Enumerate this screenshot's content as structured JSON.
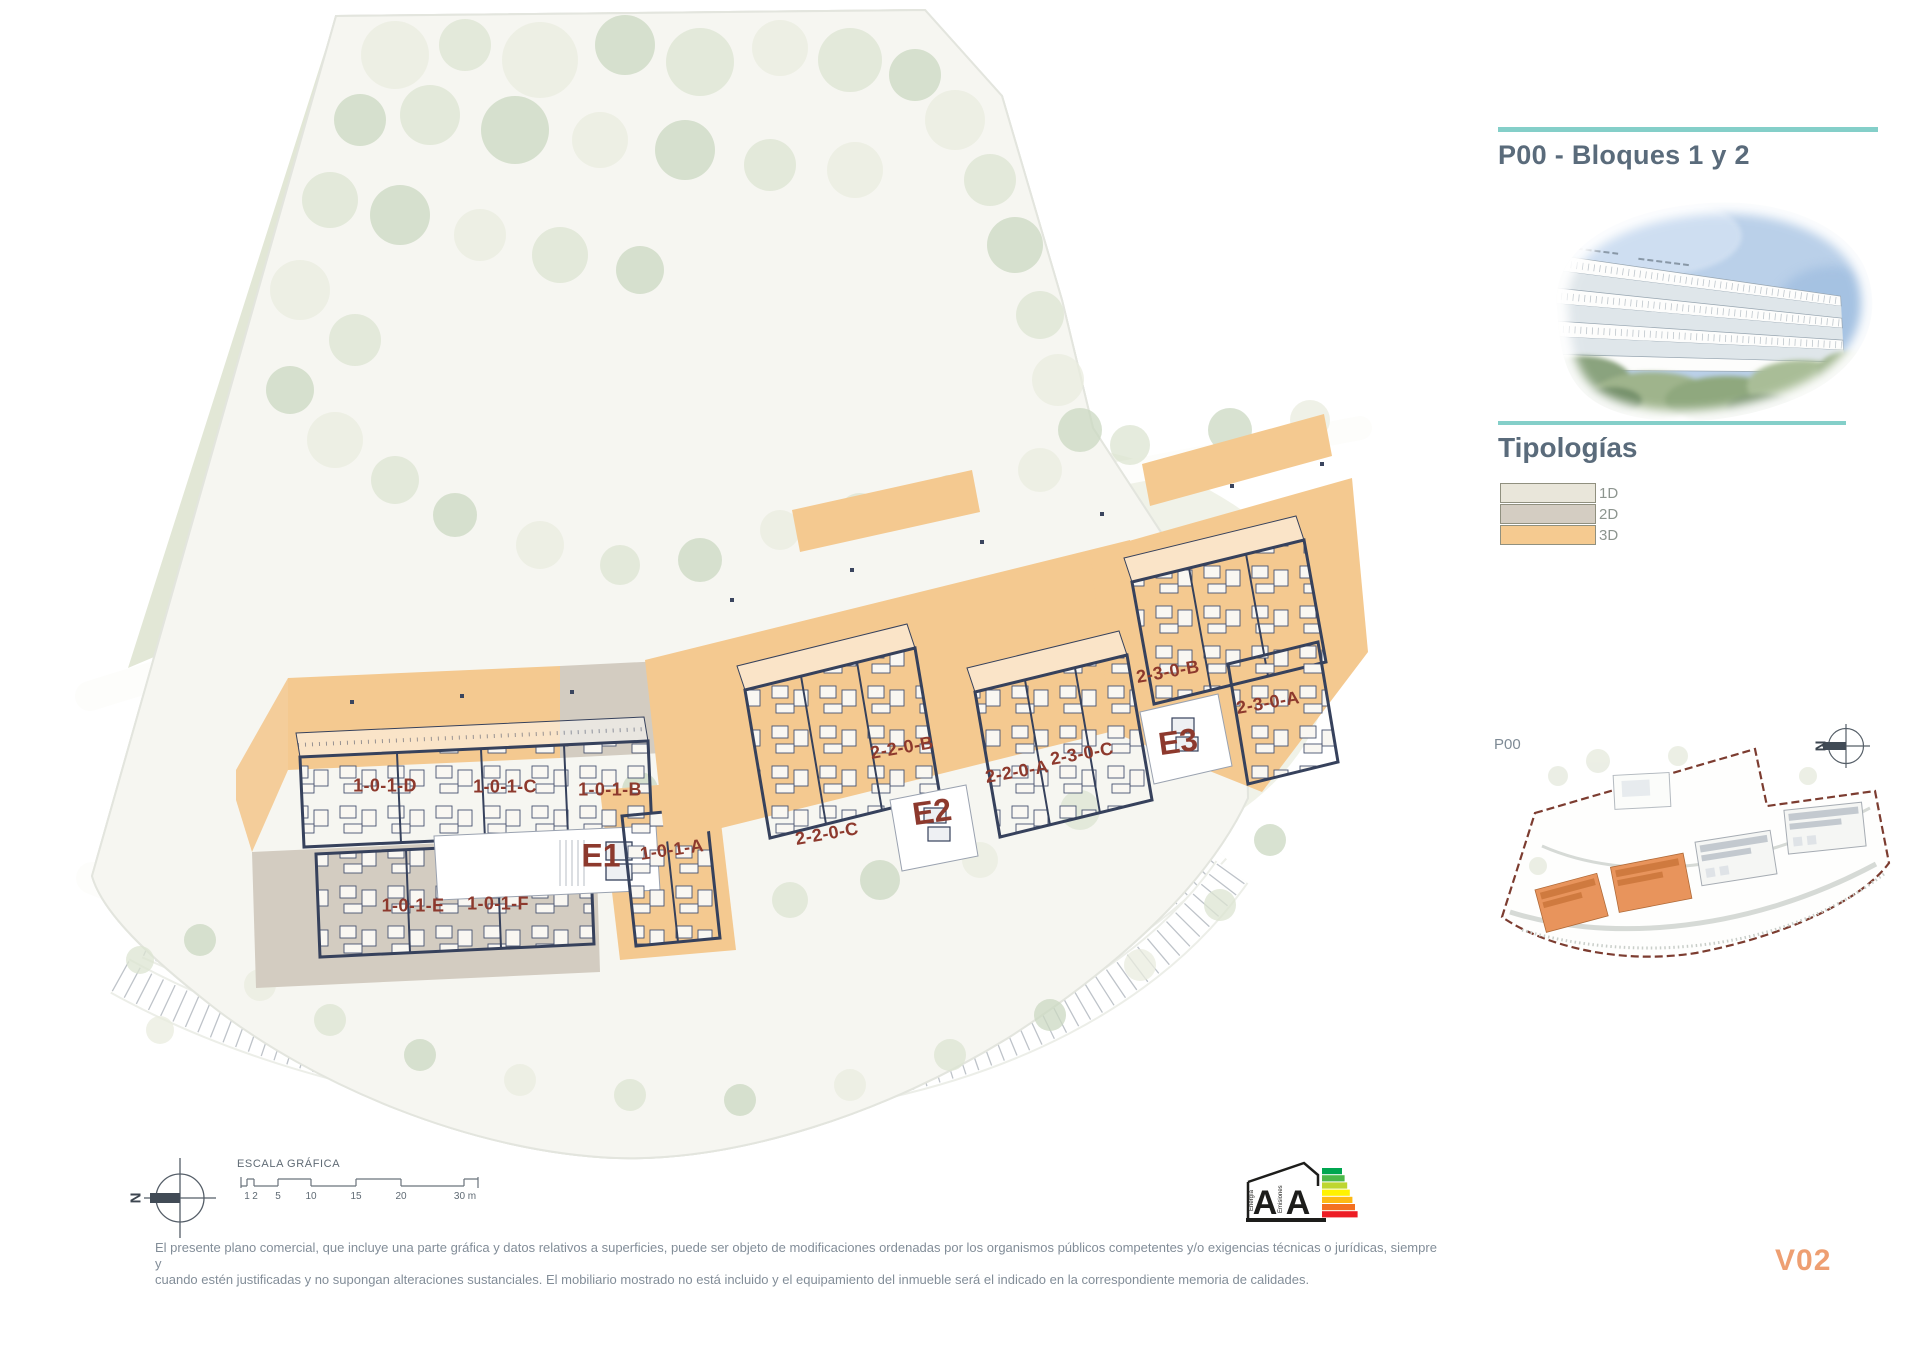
{
  "document": {
    "version_label": "V02"
  },
  "sidebar": {
    "title": "P00 - Bloques 1 y 2",
    "tipologias_heading": "Tipologías",
    "legend": [
      {
        "label": "1D",
        "color": "#e9e6da"
      },
      {
        "label": "2D",
        "color": "#d4cdc2"
      },
      {
        "label": "3D",
        "color": "#f5ca90"
      }
    ],
    "keyplan": {
      "plan_label": "P00",
      "north_letter": "N"
    }
  },
  "siteplan": {
    "north_letter": "N",
    "entrances": [
      {
        "label": "E1"
      },
      {
        "label": "E2"
      },
      {
        "label": "E3"
      }
    ],
    "units": [
      {
        "label": "1-0-1-D"
      },
      {
        "label": "1-0-1-C"
      },
      {
        "label": "1-0-1-B"
      },
      {
        "label": "1-0-1-A"
      },
      {
        "label": "1-0-1-E"
      },
      {
        "label": "1-0-1-F"
      },
      {
        "label": "2-2-0-C"
      },
      {
        "label": "2-2-0-B"
      },
      {
        "label": "2-2-0-A"
      },
      {
        "label": "2-3-0-C"
      },
      {
        "label": "2-3-0-B"
      },
      {
        "label": "2-3-0-A"
      }
    ],
    "scale": {
      "title": "ESCALA GRÁFICA",
      "tick_labels": [
        "1",
        "2",
        "5",
        "10",
        "15",
        "20"
      ],
      "end_label": "30 m"
    }
  },
  "energy_label": {
    "letter_energy": "A",
    "letter_emissions": "A",
    "axis_energy": "Energía",
    "axis_emissions": "Emisiones"
  },
  "footer": {
    "disclaimer_line1": "El presente plano comercial, que incluye una parte gráfica y datos relativos a superficies, puede ser objeto de modificaciones ordenadas por los organismos públicos competentes y/o exigencias técnicas o jurídicas, siempre y",
    "disclaimer_line2": "cuando estén justificadas y no supongan alteraciones sustanciales. El mobiliario mostrado no está incluido y el equipamiento del inmueble será el indicado en la correspondiente memoria de calidades."
  },
  "colors": {
    "accent-teal": "#84cfc9",
    "heading-slate": "#5a6b7b",
    "unit-label": "#8d392d",
    "version-orange": "#ee9f72",
    "typology-1d": "#e9e6da",
    "typology-2d": "#d4cdc2",
    "typology-3d": "#f5ca90",
    "boundary-red": "#7c3c30",
    "energy_scale": [
      "#00a650",
      "#4db848",
      "#bed630",
      "#fff200",
      "#fdb913",
      "#f37021",
      "#ed1c24"
    ]
  }
}
